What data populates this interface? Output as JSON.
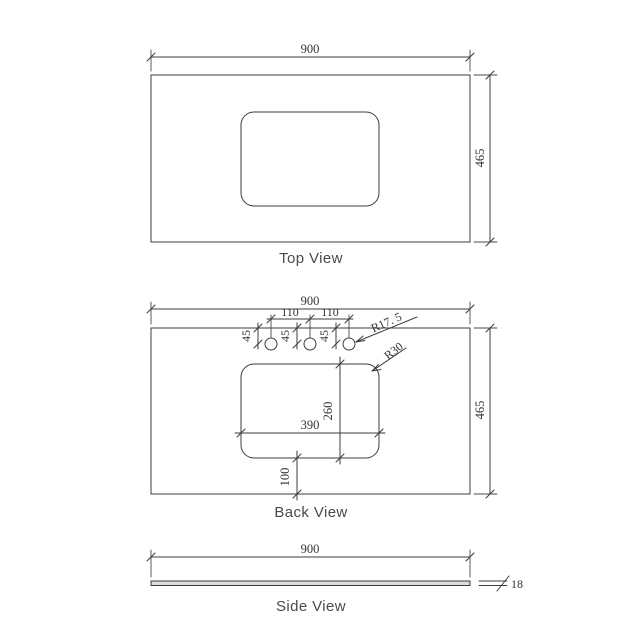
{
  "colors": {
    "line": "#3c3c3c",
    "dim_text": "#333333",
    "label_text": "#4a4a4a",
    "slab_fill": "#dcdcdc",
    "background": "#ffffff"
  },
  "views": {
    "top": {
      "label": "Top View",
      "dims": {
        "width": "900",
        "depth": "465"
      }
    },
    "back": {
      "label": "Back View",
      "dims": {
        "width": "900",
        "depth": "465",
        "hole_pitch_left": "110",
        "hole_pitch_right": "110",
        "hole_setback_1": "45",
        "hole_setback_2": "45",
        "hole_setback_3": "45",
        "hole_radius": "R17. 5",
        "cutout_corner_radius": "R30",
        "cutout_width": "390",
        "cutout_depth": "260",
        "cutout_bottom_offset": "100"
      }
    },
    "side": {
      "label": "Side View",
      "dims": {
        "width": "900",
        "thickness": "18"
      }
    }
  }
}
